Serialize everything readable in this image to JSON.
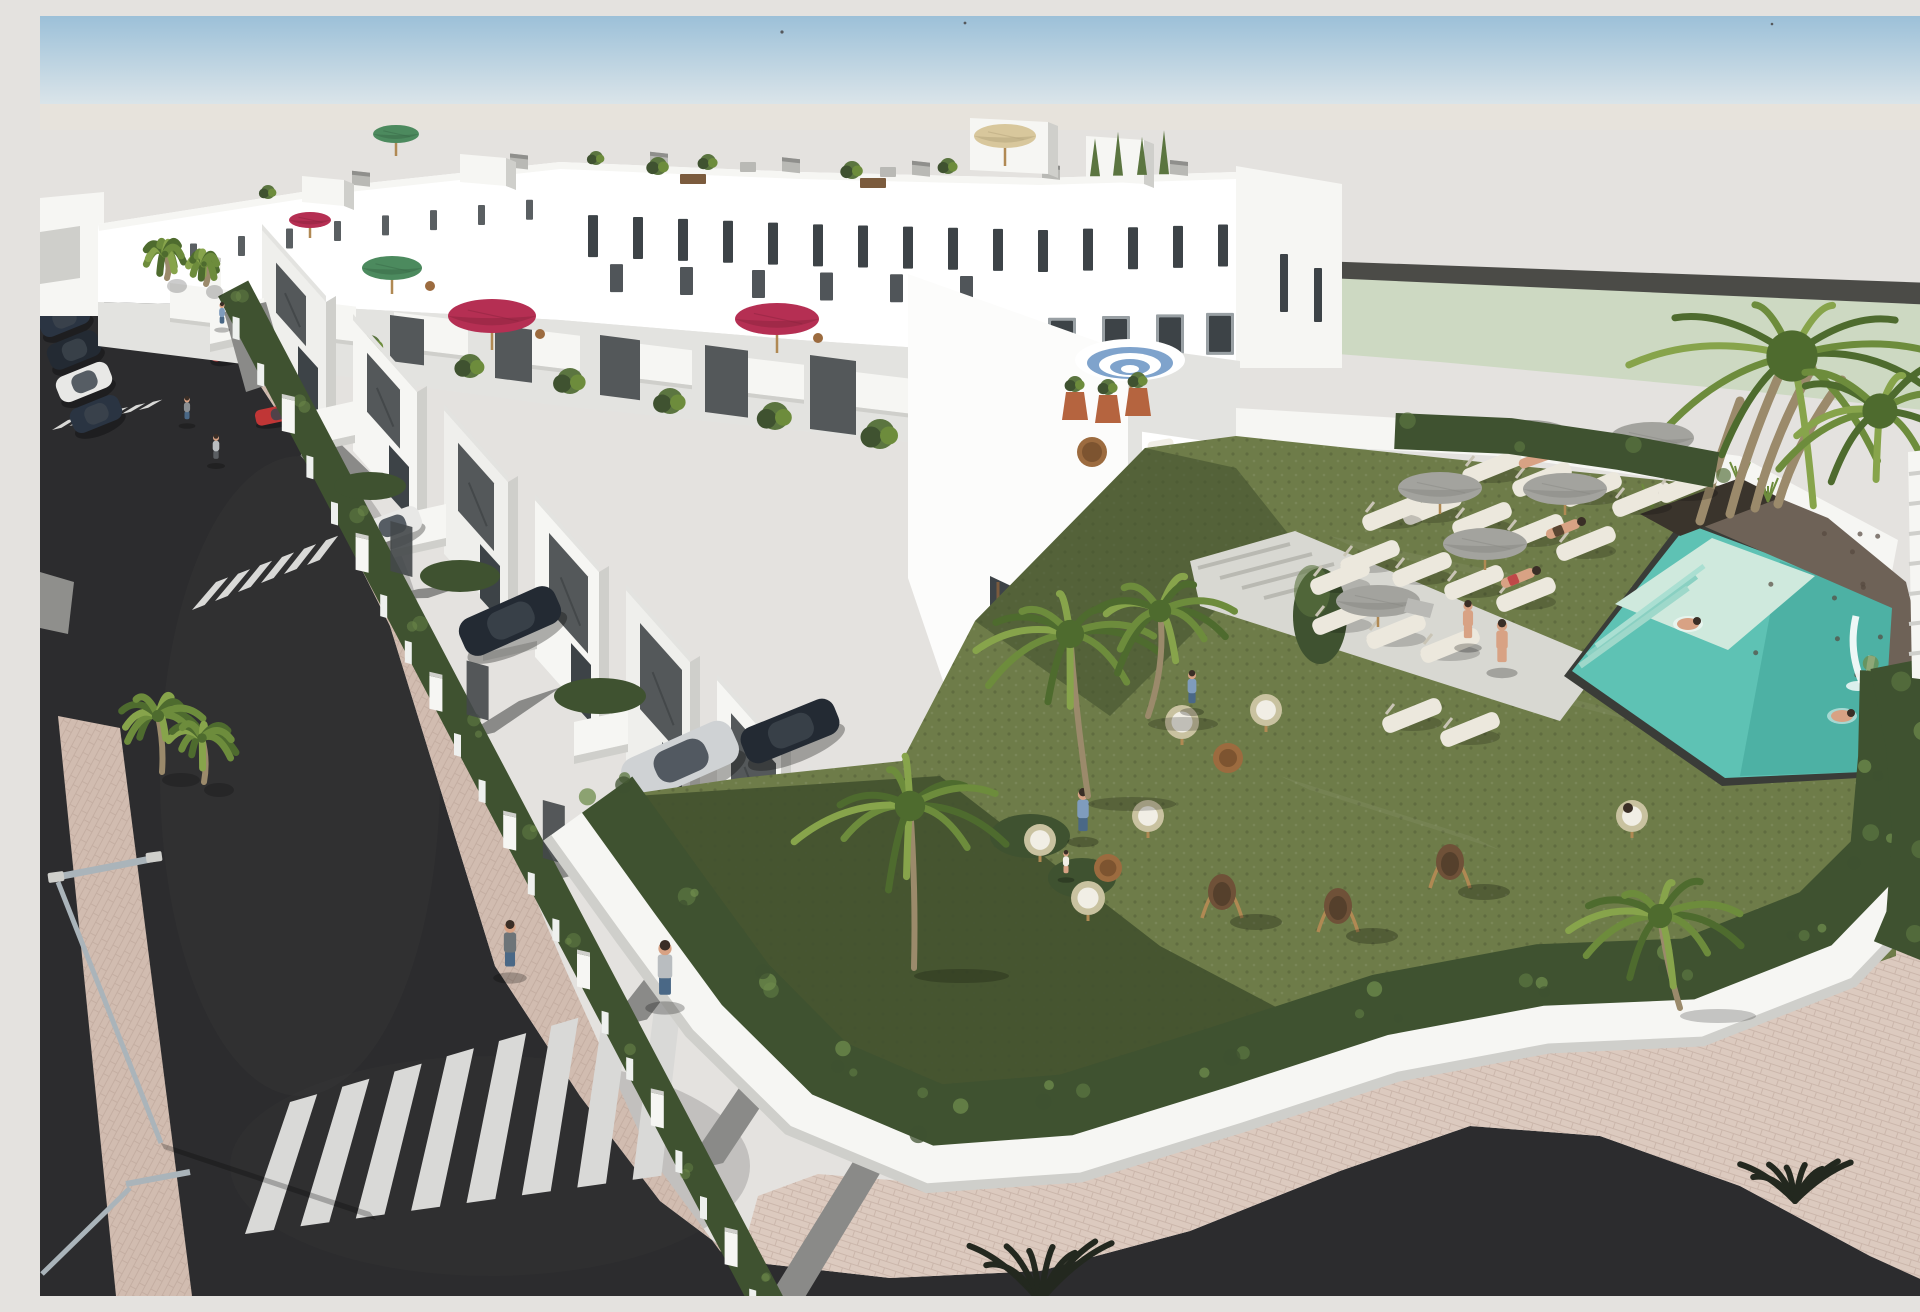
{
  "scene": {
    "title": "Aerial 3D render of a new-build terraced housing development with communal pool",
    "type": "architectural-visualization",
    "view": "high-angle-aerial"
  },
  "palette": {
    "sky_top": "#9cc0d8",
    "sky_horizon": "#dde6ea",
    "backdrop": "#e4e2df",
    "horizon_warm": "#e9e3da",
    "distant_lawn": "#cdd9c2",
    "distant_wall": "#4b4b47",
    "asphalt": "#2c2c2e",
    "asphalt_light": "#3a3a3c",
    "stripe": "#d9d9d7",
    "paver": "#d1bcb0",
    "paver_light": "#dccabf",
    "paver_joint": "#b29a8e",
    "concrete": "#d8d8d2",
    "white": "#ffffff",
    "white_warm": "#f6f6f3",
    "shade1": "#e3e3e0",
    "shade2": "#cfcfcb",
    "shade3": "#b9b9b5",
    "shade4": "#8f8f8c",
    "panel": "#54585a",
    "panel_dark": "#44484a",
    "glass": "#3d4347",
    "frame": "#99a0a4",
    "wood": "#7b5b3d",
    "hedge": "#3f5230",
    "hedge_light": "#5b7540",
    "hedge_hi": "#6f8c4c",
    "lawn": "#6e7c49",
    "lawn_light": "#7d8b53",
    "lawn_shadow": "#42512f",
    "pool": "#5ec2b4",
    "pool_deep": "#46a99c",
    "pool_step": "#8ad0c2",
    "pool_platform": "#cfe9dd",
    "pool_rim": "#3a3c38",
    "stone": "#6e6257",
    "stone_dark": "#55493f",
    "umb_grey": "#a3a39e",
    "umb_grey_dark": "#8a8a85",
    "umb_tan": "#d8c79c",
    "umb_red": "#b52f53",
    "umb_green": "#4c8a5e",
    "umb_blue": "#7fa3cc",
    "lounger": "#ece8dd",
    "wicker": "#c9c2a0",
    "cushion": "#f1eee5",
    "swing": "#6f5138",
    "stand": "#b08953",
    "table": "#9c6b3f",
    "terracotta": "#b5643f",
    "palm": "#4e6b2e",
    "palm_light": "#6d8c3c",
    "palm_hi": "#87a44b",
    "trunk": "#9b8a6b",
    "lamp": "#aab4ba",
    "car_dark": "#232a33",
    "car_navy": "#2a3442",
    "car_white": "#e8e8e6",
    "car_silver": "#cfd2d4",
    "car_red": "#c03636",
    "car_yellow": "#c8b465",
    "car_glass": "#3c444c",
    "skin": "#d8a284",
    "hair": "#3a2e26",
    "blue_top": "#7f9cbd",
    "jeans": "#4a6886",
    "grey_top": "#b9bdc0",
    "red_cloth": "#c04848",
    "dark_foliage": "#23281f"
  },
  "inventory": {
    "buildings": {
      "style": "white-modern-townhouse-rows",
      "features": [
        "roof-terraces",
        "balconies",
        "dark-shutter-panels",
        "chimneys",
        "front-gardens"
      ]
    },
    "street": {
      "crosswalks": 3,
      "lamp_posts": 2,
      "sidewalk_material": "pink-pavers"
    },
    "vehicles": [
      {
        "kind": "parked-car",
        "color": "dark-navy"
      },
      {
        "kind": "parked-car",
        "color": "dark-navy"
      },
      {
        "kind": "parked-car",
        "color": "white"
      },
      {
        "kind": "garden-car",
        "color": "red"
      },
      {
        "kind": "garden-suv",
        "color": "black"
      },
      {
        "kind": "garden-hatchback",
        "color": "silver"
      },
      {
        "kind": "garden-car",
        "color": "yellow"
      },
      {
        "kind": "garden-car",
        "color": "white"
      },
      {
        "kind": "garden-car",
        "color": "black"
      }
    ],
    "umbrellas": [
      {
        "color": "grey",
        "count": 6
      },
      {
        "color": "crimson",
        "count": 3
      },
      {
        "color": "green",
        "count": 2
      },
      {
        "color": "tan",
        "count": 1
      },
      {
        "color": "blue-white-striped",
        "count": 1
      }
    ],
    "amenities": [
      "communal-pool",
      "waterfall-wall",
      "sun-loungers",
      "wicker-chairs",
      "egg-swing-chairs",
      "lawns",
      "palm-trees",
      "perimeter-hedge"
    ],
    "people": {
      "approx_total": 16,
      "activities": [
        "swimming",
        "sunbathing",
        "walking",
        "sitting"
      ]
    }
  }
}
